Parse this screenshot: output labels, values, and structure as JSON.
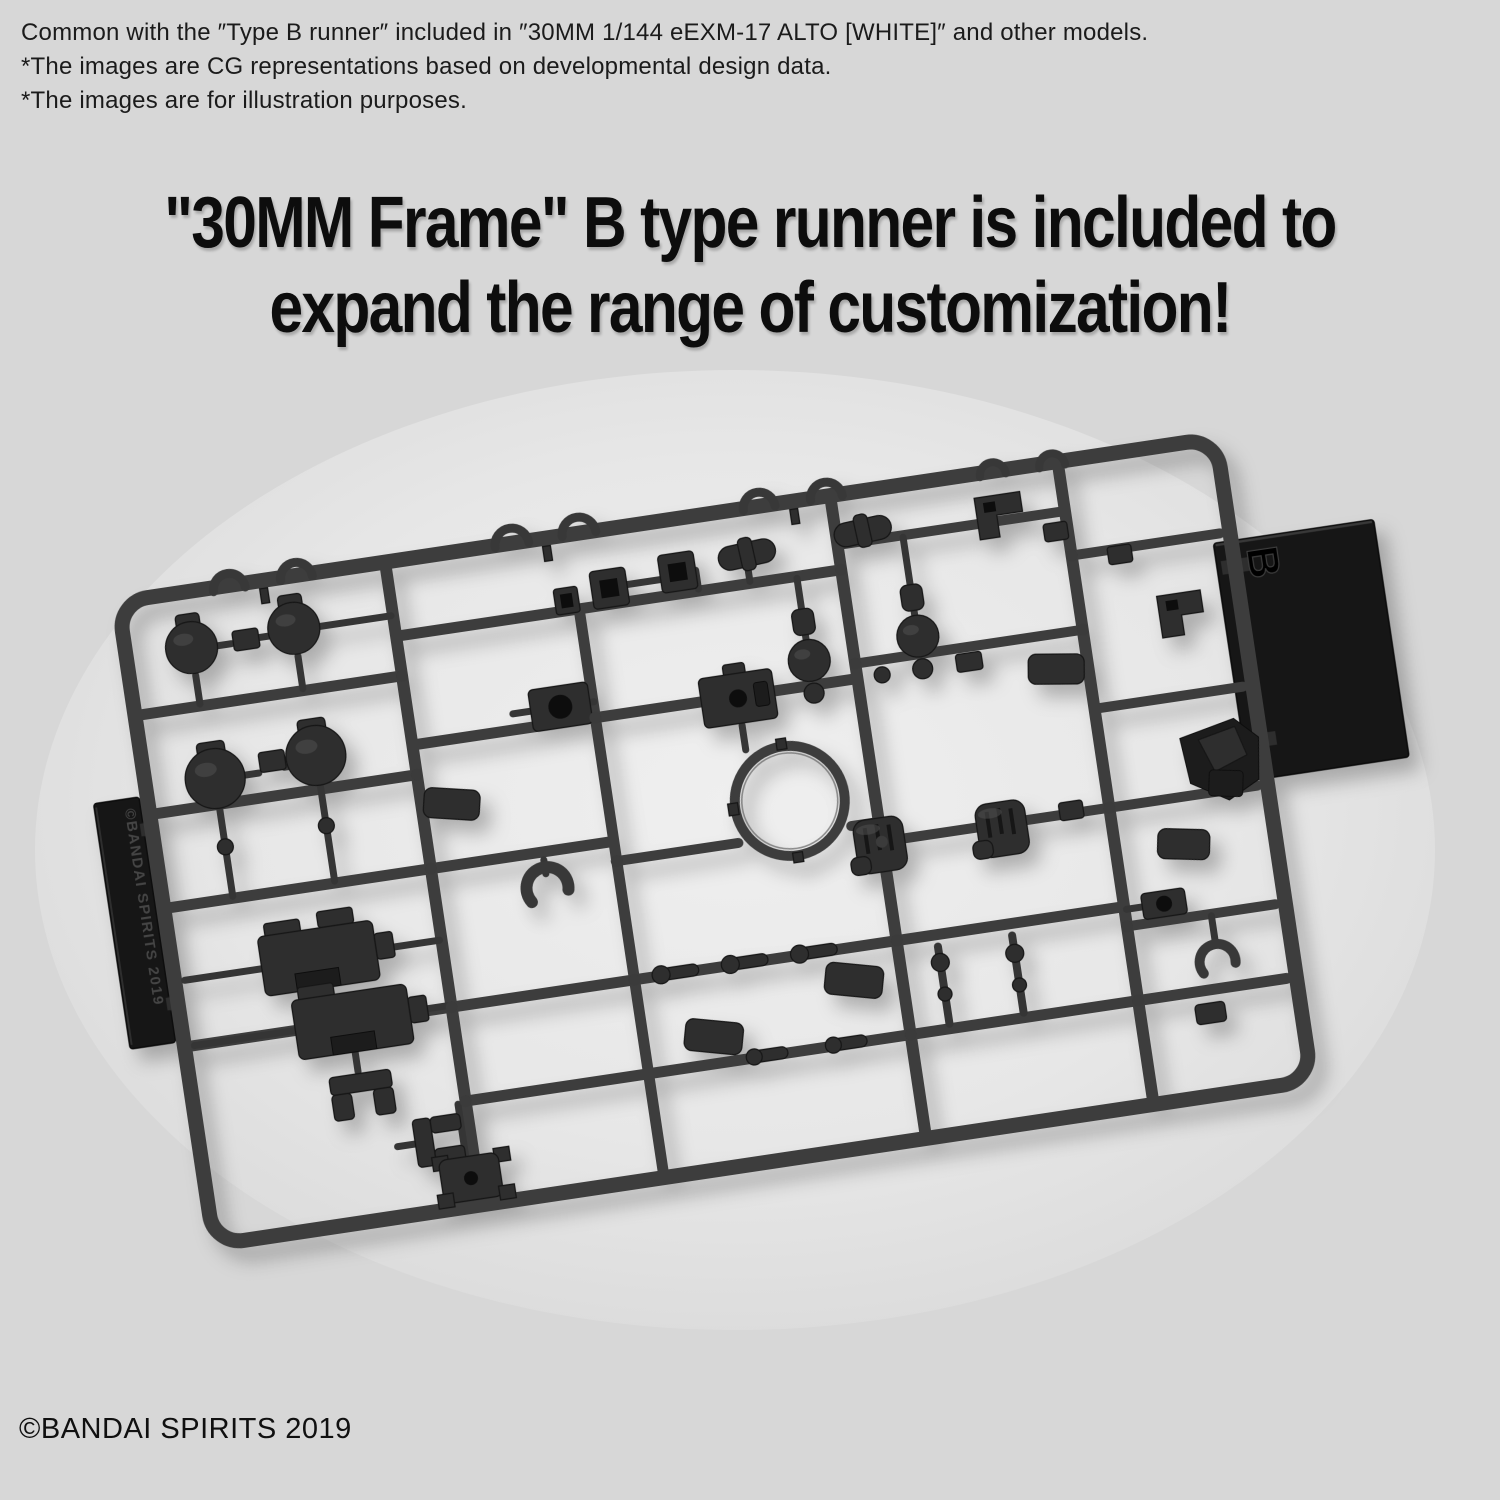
{
  "canvas": {
    "background": "#d7d7d7",
    "ink": "#0d0d0d"
  },
  "notes": {
    "line1": "Common with the ″Type B runner″ included in ″30MM 1/144 eEXM-17 ALTO [WHITE]″ and other models.",
    "line2": "*The images are CG representations based on developmental design data.",
    "line3": "*The images are for illustration purposes."
  },
  "headline": {
    "line1": "\"30MM Frame\" B type runner is included to",
    "line2": "expand the range of customization!"
  },
  "runner_photo": {
    "runner_letter": "B",
    "molded_copyright": "©BANDAI SPIRITS 2019",
    "plastic_color": "#2e2e2e",
    "rail_color": "#3d3d3d",
    "tab_color": "#171717",
    "backdrop_color": "#eeeeee"
  },
  "footer": {
    "copyright": "©BANDAI SPIRITS 2019"
  }
}
